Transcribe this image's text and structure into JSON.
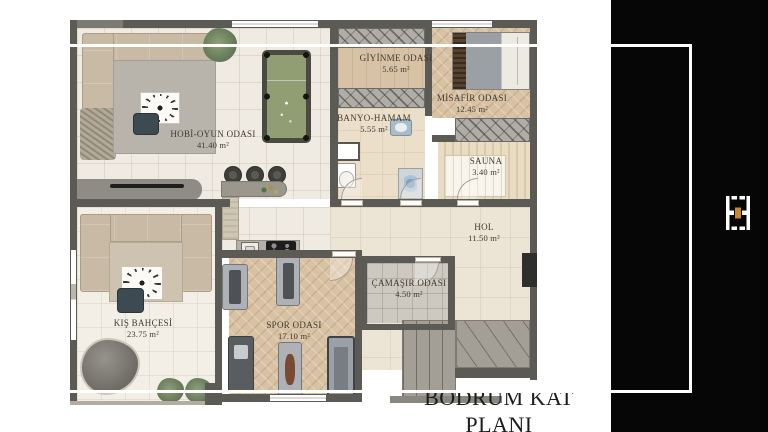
{
  "document": {
    "type": "basement floor plan"
  },
  "caption": "BODRUM KAT PLANI",
  "rooms": [
    {
      "name": "HOBİ-OYUN ODASI",
      "area": "41.40 m²"
    },
    {
      "name": "GİYİNME ODASI",
      "area": "5.65 m²"
    },
    {
      "name": "MİSAFİR ODASI",
      "area": "12.45 m²"
    },
    {
      "name": "BANYO-HAMAM",
      "area": "5.55 m²"
    },
    {
      "name": "SAUNA",
      "area": "3.40 m²"
    },
    {
      "name": "HOL",
      "area": "11.50 m²"
    },
    {
      "name": "ÇAMAŞIR ODASI",
      "area": "4.50 m²"
    },
    {
      "name": "KIŞ BAHÇESİ",
      "area": "23.75 m²"
    },
    {
      "name": "SPOR ODASI",
      "area": "17.10 m²"
    }
  ],
  "sidebar": {
    "background_color": "#060606",
    "frame_color": "#ffffff",
    "logo": {
      "name": "brand-mark",
      "accent_color": "#c8862f",
      "mark_color": "#ffffff"
    }
  },
  "colors": {
    "wall": "#5b5a55",
    "wood_floor": "#d9c2a4",
    "tile_floor": "#f0ebe2",
    "pool_felt": "#919d73"
  }
}
